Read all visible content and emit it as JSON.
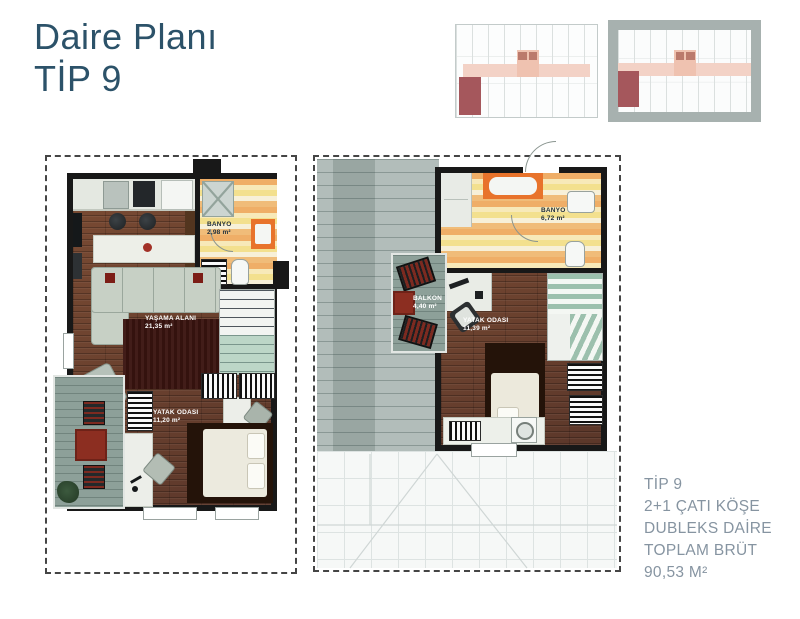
{
  "title": {
    "line1": "Daire Planı",
    "line2": "TİP 9"
  },
  "plans": {
    "lower": {
      "banyo": {
        "name": "BANYO",
        "area": "2,98 m²"
      },
      "yasama": {
        "name": "YAŞAMA ALANI",
        "area": "21,35 m²"
      },
      "yatak": {
        "name": "YATAK ODASI",
        "area": "11,20 m²"
      }
    },
    "upper": {
      "banyo": {
        "name": "BANYO",
        "area": "6,72 m²"
      },
      "balkon": {
        "name": "BALKON",
        "area": "4,40 m²"
      },
      "yatak": {
        "name": "YATAK ODASI",
        "area": "11,39 m²"
      }
    }
  },
  "summary": {
    "lines": [
      "TİP 9",
      "2+1 ÇATI KÖŞE",
      "DUBLEKS DAİRE",
      "TOPLAM BRÜT",
      "90,53 M²"
    ]
  },
  "colors": {
    "title_text": "#2c5269",
    "summary_text": "#8694a1",
    "wall": "#181818",
    "wood_floor": "#6a4130",
    "bathroom_orange": "#e8732b",
    "bathroom_stripe_yellow": "#f3e08e",
    "balcony_floor": "#8da099",
    "roof_gray": "#b2bdba",
    "stair_green": "#9cc0ad",
    "keyplan_corridor_pink": "#f3d2c6",
    "keyplan_highlight_unit": "#a5575c",
    "rug_maroon": "#3a1410"
  }
}
